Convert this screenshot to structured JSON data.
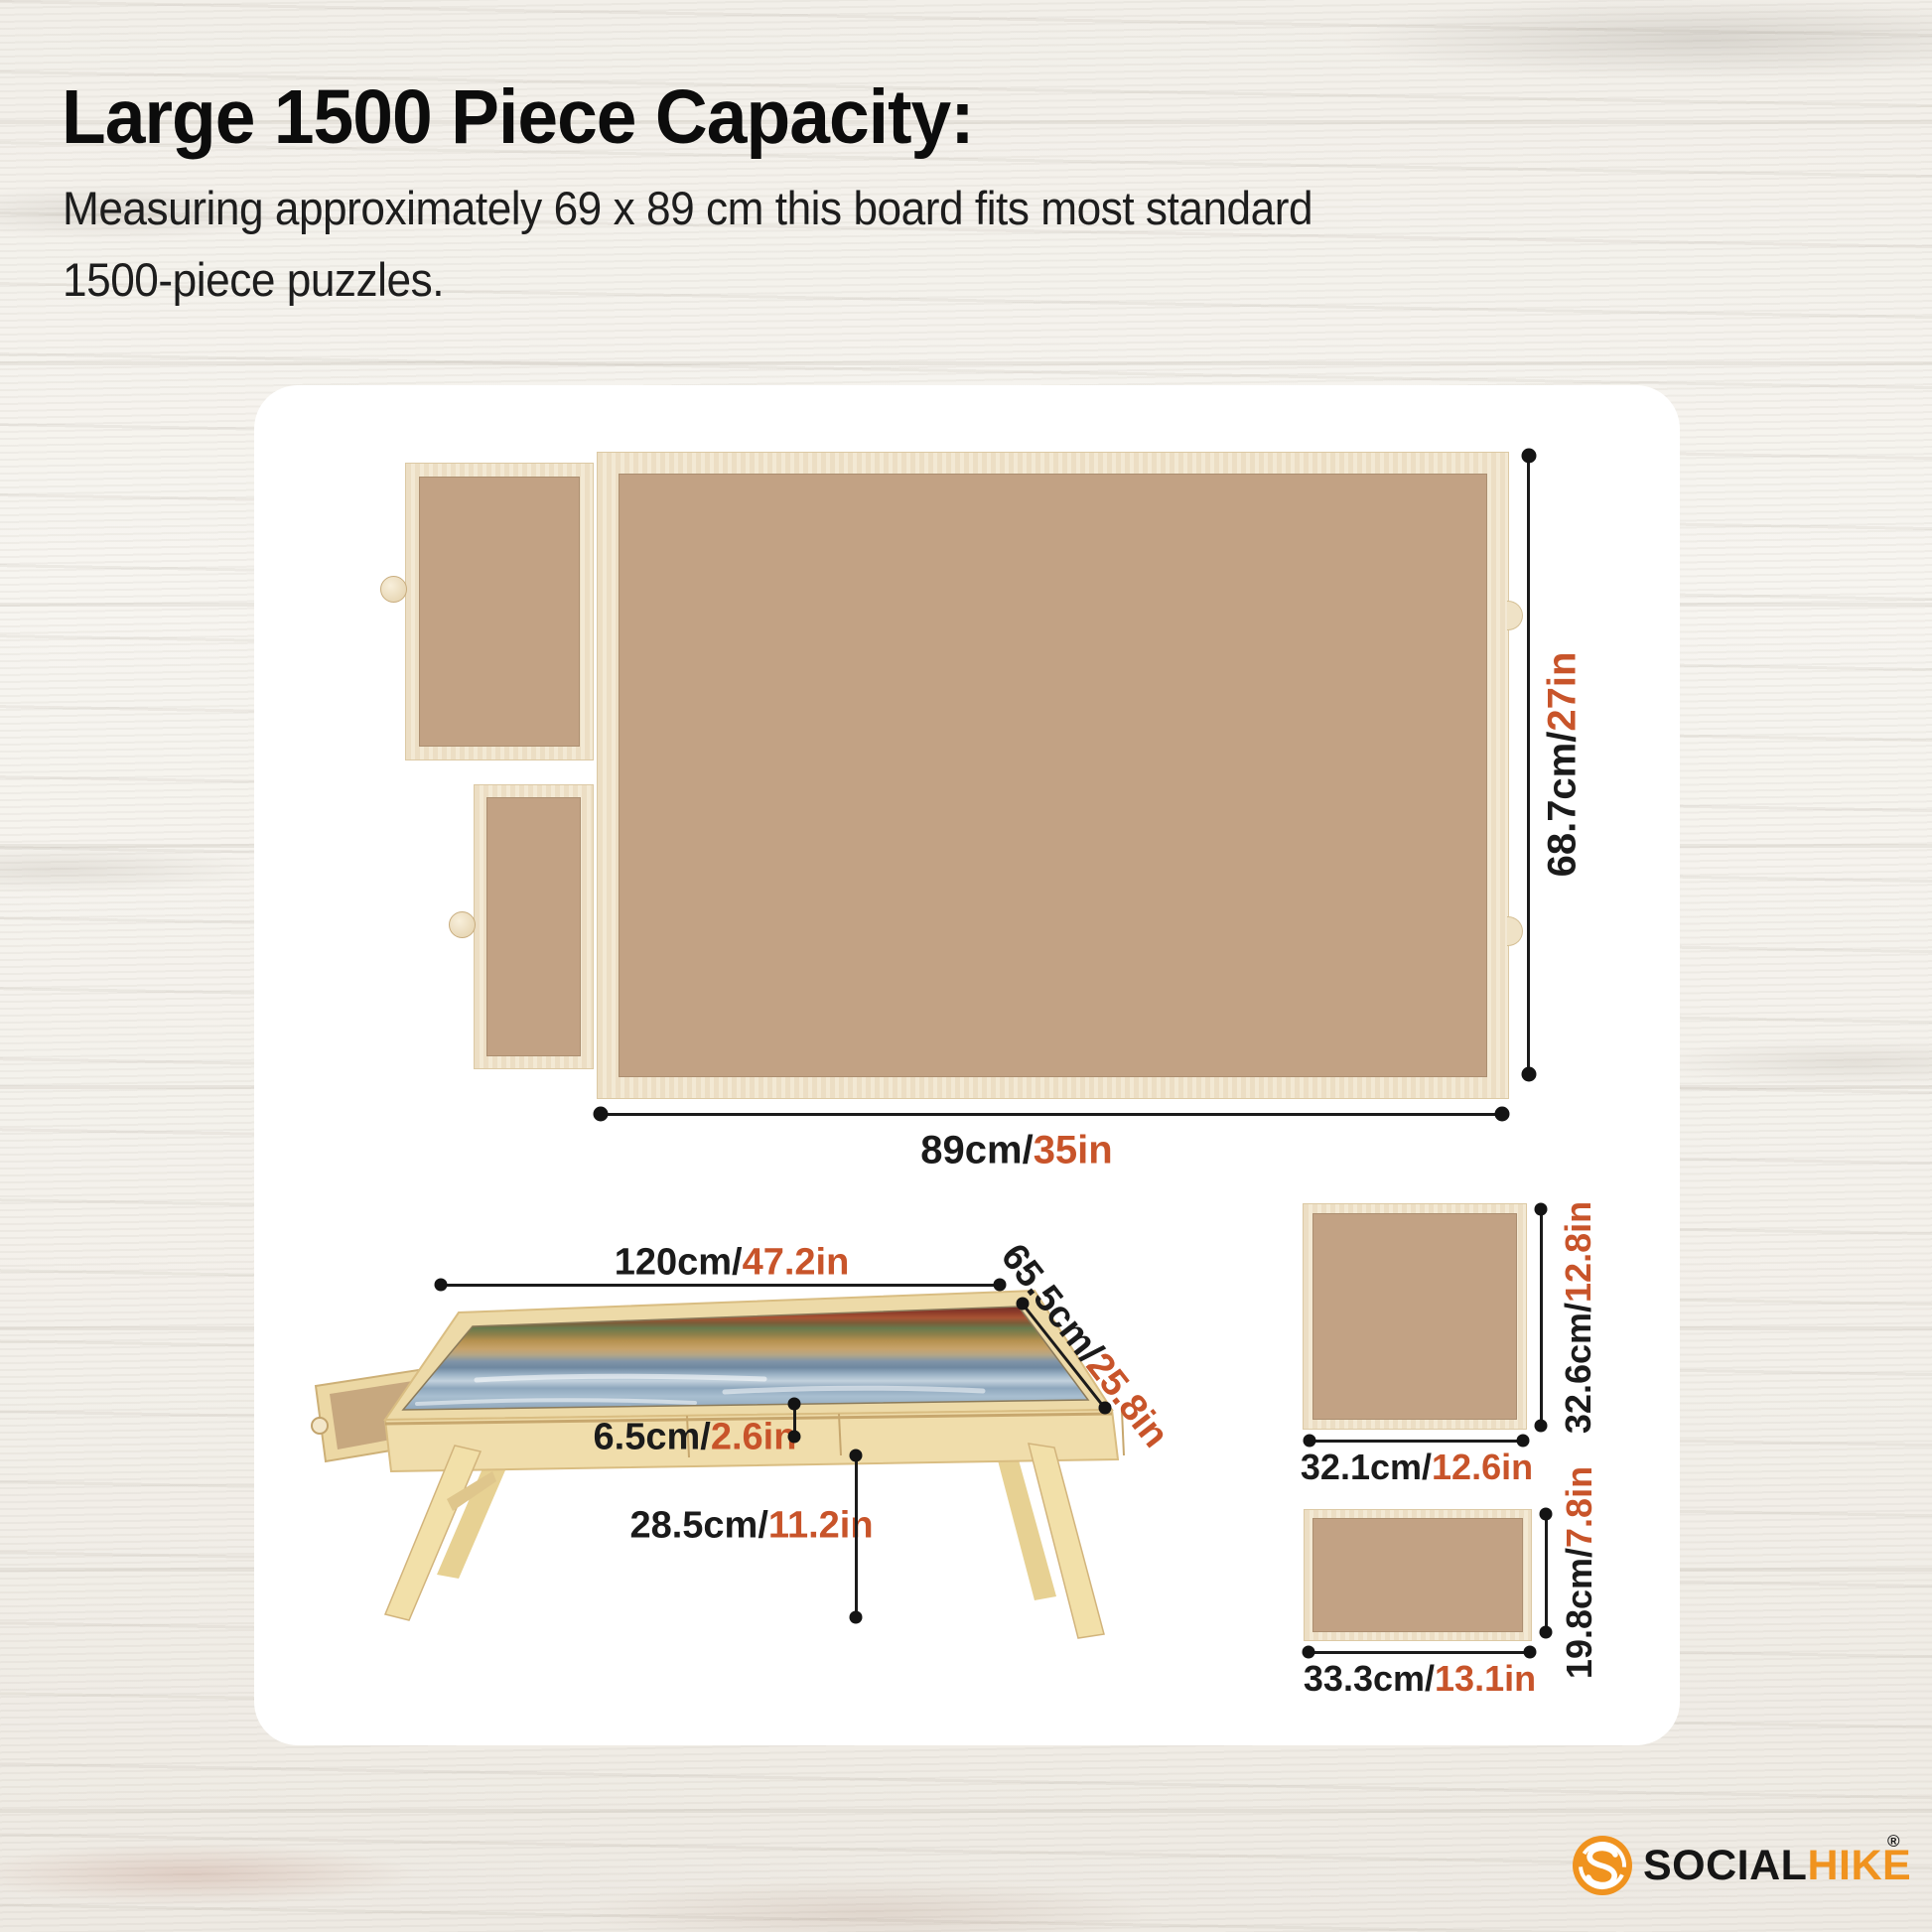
{
  "header": {
    "title": "Large 1500 Piece Capacity:",
    "subtitle_line1": "Measuring approximately 69 x 89 cm this board fits most standard",
    "subtitle_line2": "1500-piece puzzles."
  },
  "board_diagram": {
    "height": {
      "metric": "68.7cm/",
      "imperial": "27in"
    },
    "width": {
      "metric": "89cm/",
      "imperial": "35in"
    }
  },
  "table_diagram": {
    "length": {
      "metric": "120cm/",
      "imperial": "47.2in"
    },
    "depth": {
      "metric": "65.5cm/",
      "imperial": "25.8in"
    },
    "drawer_height": {
      "metric": "6.5cm/",
      "imperial": "2.6in"
    },
    "leg_height": {
      "metric": "28.5cm/",
      "imperial": "11.2in"
    }
  },
  "square_board": {
    "height": {
      "metric": "32.6cm/",
      "imperial": "12.8in"
    },
    "width": {
      "metric": "32.1cm/",
      "imperial": "12.6in"
    }
  },
  "small_board": {
    "height": {
      "metric": "19.8cm/",
      "imperial": "7.8in"
    },
    "width": {
      "metric": "33.3cm/",
      "imperial": "13.1in"
    }
  },
  "brand": {
    "name_primary": "SOCIAL",
    "name_secondary": "HIKE",
    "registered_mark": "®"
  },
  "colors": {
    "accent_orange": "#c8542a",
    "logo_orange": "#f0931f",
    "ink": "#1b1b1b"
  }
}
